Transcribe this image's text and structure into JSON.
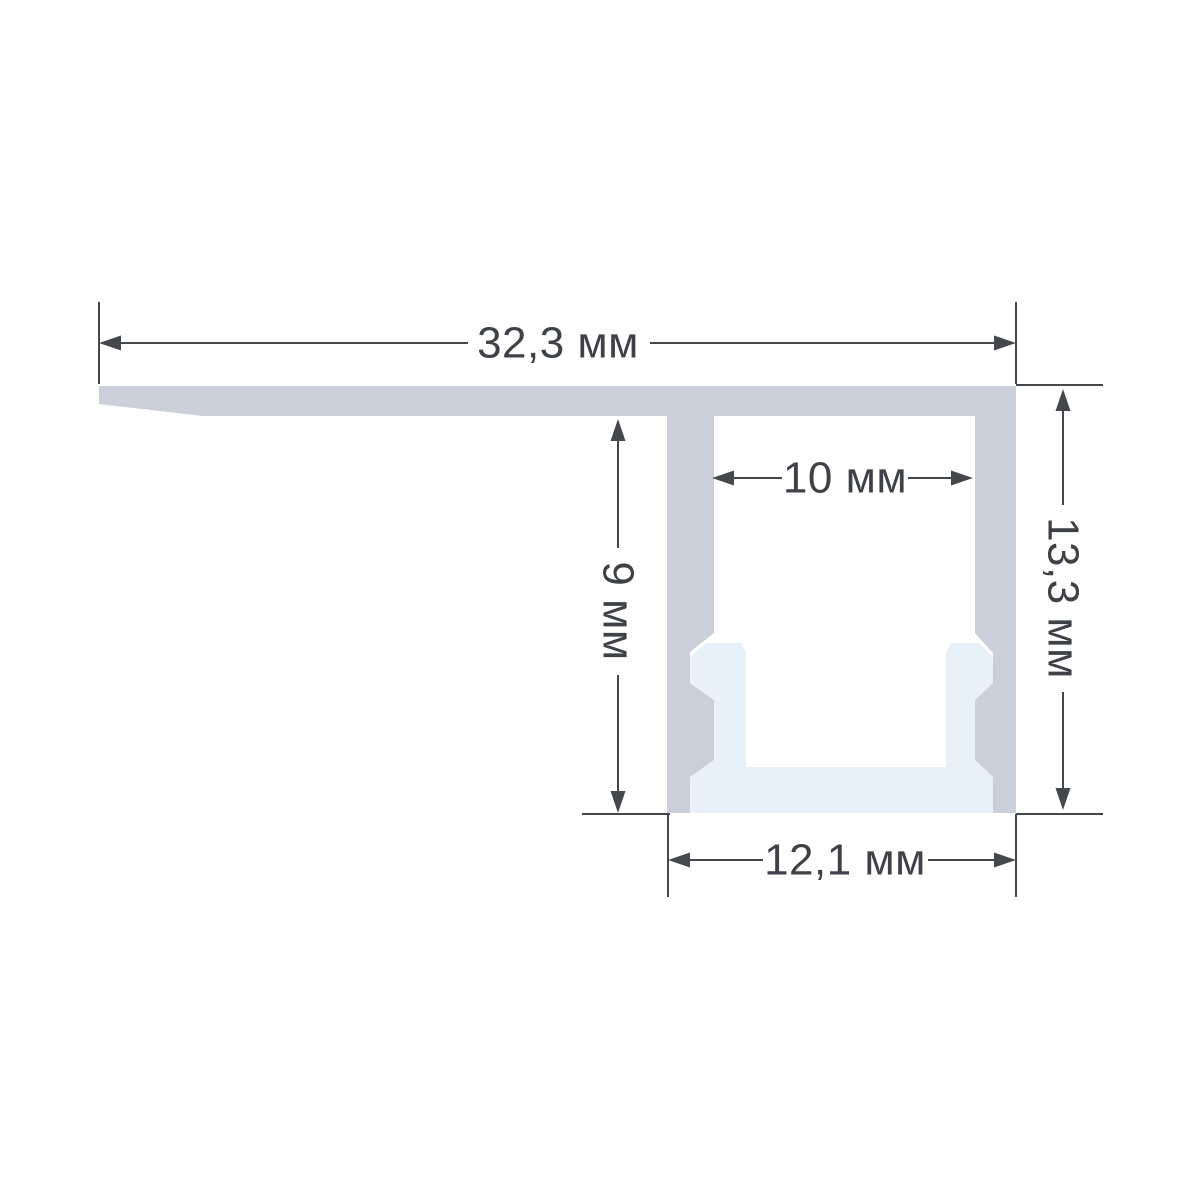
{
  "drawing": {
    "type": "technical cross-section of aluminum LED profile with diffuser",
    "unit": "мм",
    "colors": {
      "background": "#ffffff",
      "aluminum": "#cbcfd9",
      "diffuser": "#e8f1f8",
      "line": "#44484d",
      "text": "#3e4247"
    },
    "dimensions": {
      "overall_width": {
        "label": "32,3 мм",
        "value_mm": 32.3
      },
      "slot_inner_width": {
        "label": "10 мм",
        "value_mm": 10
      },
      "body_height": {
        "label": "9 мм",
        "value_mm": 9
      },
      "overall_height": {
        "label": "13,3 мм",
        "value_mm": 13.3
      },
      "body_outer_width": {
        "label": "12,1 мм",
        "value_mm": 12.1
      }
    }
  }
}
